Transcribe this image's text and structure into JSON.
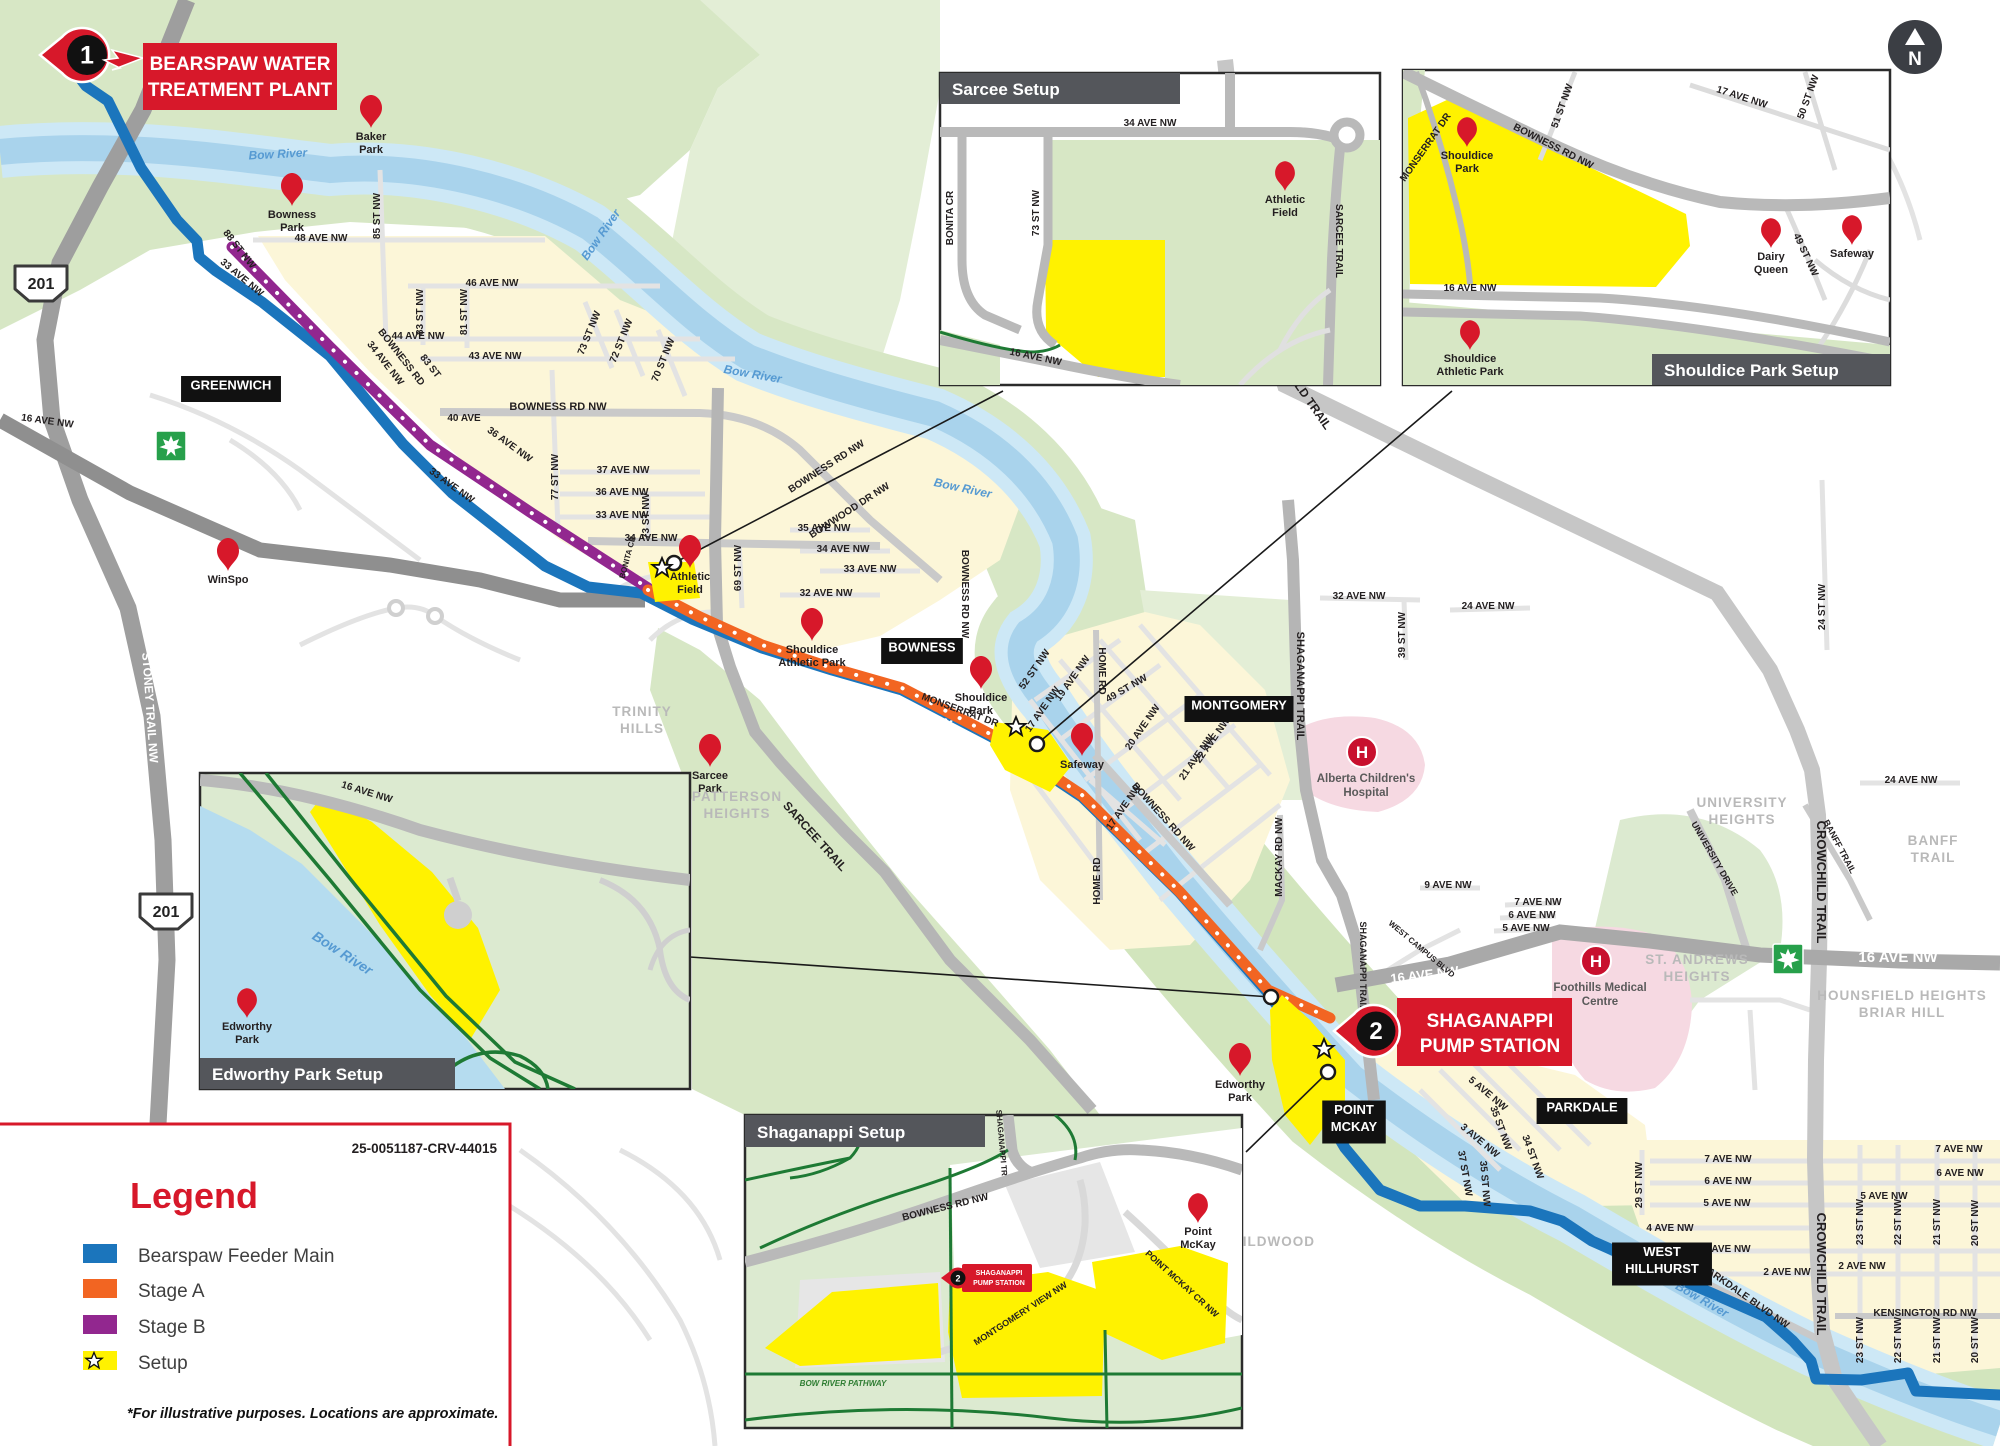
{
  "doc_number": "25-0051187-CRV-44015",
  "north_label": "N",
  "colors": {
    "route_blue": "#1b75bc",
    "stage_a": "#f26522",
    "stage_b": "#92278f",
    "setup_yellow": "#fff200",
    "brand_red": "#d7182a",
    "inset_bar": "#54565b",
    "water": "#a9d3ec",
    "park_green": "#d7e7c5",
    "trail_green": "#1e7a34",
    "hospital_pink": "#f6d9e2"
  },
  "legend": {
    "title": "Legend",
    "items": [
      {
        "label": "Bearspaw Feeder Main",
        "color": "#1b75bc",
        "star": false
      },
      {
        "label": "Stage A",
        "color": "#f26522",
        "star": false
      },
      {
        "label": "Stage B",
        "color": "#92278f",
        "star": false
      },
      {
        "label": "Setup",
        "color": "#fff200",
        "star": true
      }
    ],
    "note": "*For illustrative purposes. Locations are approximate."
  },
  "callouts": {
    "bearspaw": {
      "number": "1",
      "line1": "BEARSPAW WATER",
      "line2": "TREATMENT PLANT"
    },
    "shaganappi": {
      "number": "2",
      "line1": "SHAGANAPPI",
      "line2": "PUMP STATION"
    }
  },
  "insets": {
    "sarcee": {
      "title": "Sarcee Setup"
    },
    "shouldice": {
      "title": "Shouldice Park Setup"
    },
    "edworthy": {
      "title": "Edworthy Park Setup"
    },
    "shaganappi": {
      "title": "Shaganappi Setup"
    }
  },
  "shields": {
    "hwy": "201"
  },
  "map": {
    "street_labels": [
      {
        "t": "16 AVE NW",
        "x": 47,
        "y": 424,
        "r": 8
      },
      {
        "t": "48 AVE NW",
        "x": 321,
        "y": 241
      },
      {
        "t": "85 ST NW",
        "x": 380,
        "y": 216,
        "r": -90
      },
      {
        "t": "88 ST NW",
        "x": 237,
        "y": 251,
        "r": 52
      },
      {
        "t": "33 AVE NW",
        "x": 240,
        "y": 280,
        "r": 40
      },
      {
        "t": "46 AVE NW",
        "x": 492,
        "y": 286
      },
      {
        "t": "83 ST NW",
        "x": 423,
        "y": 312,
        "r": -90
      },
      {
        "t": "81 ST NW",
        "x": 467,
        "y": 312,
        "r": -90
      },
      {
        "t": "44 AVE NW",
        "x": 418,
        "y": 339
      },
      {
        "t": "43 AVE NW",
        "x": 495,
        "y": 359
      },
      {
        "t": "BOWNESS RD",
        "x": 399,
        "y": 359,
        "r": 52
      },
      {
        "t": "34 AVE NW",
        "x": 383,
        "y": 365,
        "r": 52
      },
      {
        "t": "83 ST",
        "x": 428,
        "y": 368,
        "r": 52
      },
      {
        "t": "BOWNESS RD NW",
        "x": 558,
        "y": 410,
        "s": 11
      },
      {
        "t": "40 AVE",
        "x": 464,
        "y": 421
      },
      {
        "t": "36 AVE NW",
        "x": 508,
        "y": 447,
        "r": 36
      },
      {
        "t": "33 AVE NW",
        "x": 450,
        "y": 488,
        "r": 36
      },
      {
        "t": "37 AVE NW",
        "x": 623,
        "y": 473
      },
      {
        "t": "36 AVE NW",
        "x": 622,
        "y": 495
      },
      {
        "t": "33 AVE NW",
        "x": 622,
        "y": 518
      },
      {
        "t": "77 ST NW",
        "x": 558,
        "y": 477,
        "r": -90
      },
      {
        "t": "73 ST NW",
        "x": 592,
        "y": 334,
        "r": -68
      },
      {
        "t": "72 ST NW",
        "x": 624,
        "y": 342,
        "r": -68
      },
      {
        "t": "70 ST NW",
        "x": 666,
        "y": 361,
        "r": -68
      },
      {
        "t": "34 AVE NW",
        "x": 651,
        "y": 541
      },
      {
        "t": "BONITA CR",
        "x": 630,
        "y": 558,
        "r": -75,
        "s": 8
      },
      {
        "t": "73 ST NW",
        "x": 649,
        "y": 516,
        "r": -90
      },
      {
        "t": "69 ST NW",
        "x": 741,
        "y": 568,
        "r": -90
      },
      {
        "t": "40 AVE NW",
        "x": 1055,
        "y": 337
      },
      {
        "t": "35 AVE NW",
        "x": 824,
        "y": 531
      },
      {
        "t": "34 AVE NW",
        "x": 843,
        "y": 552
      },
      {
        "t": "33 AVE NW",
        "x": 870,
        "y": 572
      },
      {
        "t": "32 AVE NW",
        "x": 826,
        "y": 596
      },
      {
        "t": "BOWNESS RD NW",
        "x": 828,
        "y": 469,
        "r": -33
      },
      {
        "t": "BOWWOOD DR NW",
        "x": 851,
        "y": 513,
        "r": -33
      },
      {
        "t": "BOWNESS RD NW",
        "x": 962,
        "y": 594,
        "r": 90
      },
      {
        "t": "MONSERRAT DR",
        "x": 959,
        "y": 713,
        "r": 20
      },
      {
        "t": "16 AVE NW",
        "x": 912,
        "y": 717,
        "r": 20,
        "s": 15,
        "c": "#ffffff"
      },
      {
        "t": "52 ST NW",
        "x": 1037,
        "y": 671,
        "r": -55
      },
      {
        "t": "19 AVE NW",
        "x": 1075,
        "y": 680,
        "r": -55
      },
      {
        "t": "17 AVE NW",
        "x": 1045,
        "y": 711,
        "r": -55
      },
      {
        "t": "HOME RD",
        "x": 1099,
        "y": 671,
        "r": 90
      },
      {
        "t": "49 ST NW",
        "x": 1128,
        "y": 691,
        "r": -30
      },
      {
        "t": "20 AVE NW",
        "x": 1145,
        "y": 729,
        "r": -55
      },
      {
        "t": "22 AVE NW",
        "x": 1215,
        "y": 742,
        "r": -55
      },
      {
        "t": "21 AVE NW",
        "x": 1199,
        "y": 759,
        "r": -55
      },
      {
        "t": "17 AVE NW",
        "x": 1126,
        "y": 809,
        "r": -55
      },
      {
        "t": "BOWNESS RD NW",
        "x": 1161,
        "y": 819,
        "r": 48
      },
      {
        "t": "MACKAY RD NW",
        "x": 1282,
        "y": 857,
        "r": -90
      },
      {
        "t": "HOME RD",
        "x": 1100,
        "y": 881,
        "r": -90
      },
      {
        "t": "SHAGANAPPI TRAIL",
        "x": 1297,
        "y": 686,
        "r": 90,
        "s": 11
      },
      {
        "t": "32 AVE NW",
        "x": 1359,
        "y": 599
      },
      {
        "t": "39 ST NW",
        "x": 1405,
        "y": 635,
        "r": -90
      },
      {
        "t": "24 AVE NW",
        "x": 1488,
        "y": 609
      },
      {
        "t": "24 AVE NW",
        "x": 1911,
        "y": 783
      },
      {
        "t": "24 ST NW",
        "x": 1825,
        "y": 607,
        "r": -90
      },
      {
        "t": "CROWCHILD TRAIL",
        "x": 1293,
        "y": 384,
        "r": 55,
        "s": 12
      },
      {
        "t": "CROWCHILD TRAIL",
        "x": 1817,
        "y": 882,
        "r": 90,
        "s": 13
      },
      {
        "t": "CROWCHILD TRAIL",
        "x": 1817,
        "y": 1274,
        "r": 90,
        "s": 13
      },
      {
        "t": "BANFF TRAIL",
        "x": 1837,
        "y": 848,
        "r": 62,
        "s": 9
      },
      {
        "t": "UNIVERSITY DRIVE",
        "x": 1712,
        "y": 860,
        "r": 60,
        "s": 9
      },
      {
        "t": "16 AVE NW",
        "x": 1898,
        "y": 962,
        "s": 15,
        "c": "#ffffff"
      },
      {
        "t": "16 AVE NW",
        "x": 1425,
        "y": 979,
        "r": -7,
        "s": 13,
        "c": "#ffffff"
      },
      {
        "t": "WEST CAMPUS BLVD",
        "x": 1420,
        "y": 951,
        "r": 40,
        "s": 8
      },
      {
        "t": "SHAGANAPPI TRAIL",
        "x": 1360,
        "y": 966,
        "r": 90,
        "s": 9
      },
      {
        "t": "5 AVE NW",
        "x": 1486,
        "y": 1096,
        "r": 40
      },
      {
        "t": "35 ST NW",
        "x": 1498,
        "y": 1129,
        "r": 70
      },
      {
        "t": "3 AVE NW",
        "x": 1478,
        "y": 1143,
        "r": 40
      },
      {
        "t": "34 ST NW",
        "x": 1530,
        "y": 1158,
        "r": 70
      },
      {
        "t": "37 ST NW",
        "x": 1462,
        "y": 1174,
        "r": 80
      },
      {
        "t": "35 ST NW",
        "x": 1482,
        "y": 1184,
        "r": 85
      },
      {
        "t": "29 ST NW",
        "x": 1642,
        "y": 1185,
        "r": -90
      },
      {
        "t": "7 AVE NW",
        "x": 1728,
        "y": 1162
      },
      {
        "t": "6 AVE NW",
        "x": 1728,
        "y": 1184
      },
      {
        "t": "5 AVE NW",
        "x": 1727,
        "y": 1206
      },
      {
        "t": "4 AVE NW",
        "x": 1670,
        "y": 1231
      },
      {
        "t": "3 AVE NW",
        "x": 1727,
        "y": 1252
      },
      {
        "t": "2 AVE NW",
        "x": 1787,
        "y": 1275
      },
      {
        "t": "2 AVE NW",
        "x": 1862,
        "y": 1269
      },
      {
        "t": "PARKDALE BLVD NW",
        "x": 1744,
        "y": 1299,
        "r": 35
      },
      {
        "t": "KENSINGTON RD NW",
        "x": 1925,
        "y": 1316
      },
      {
        "t": "23 ST NW",
        "x": 1863,
        "y": 1222,
        "r": -90
      },
      {
        "t": "22 ST NW",
        "x": 1901,
        "y": 1222,
        "r": -90
      },
      {
        "t": "21 ST NW",
        "x": 1940,
        "y": 1222,
        "r": -90
      },
      {
        "t": "20 ST NW",
        "x": 1978,
        "y": 1223,
        "r": -90
      },
      {
        "t": "23 ST NW",
        "x": 1863,
        "y": 1340,
        "r": -90
      },
      {
        "t": "22 ST NW",
        "x": 1901,
        "y": 1340,
        "r": -90
      },
      {
        "t": "21 ST NW",
        "x": 1940,
        "y": 1340,
        "r": -90
      },
      {
        "t": "20 ST NW",
        "x": 1978,
        "y": 1340,
        "r": -90
      },
      {
        "t": "7 AVE NW",
        "x": 1959,
        "y": 1152
      },
      {
        "t": "6 AVE NW",
        "x": 1960,
        "y": 1176
      },
      {
        "t": "5 AVE NW",
        "x": 1884,
        "y": 1199
      },
      {
        "t": "9 AVE NW",
        "x": 1448,
        "y": 888
      },
      {
        "t": "7 AVE NW",
        "x": 1538,
        "y": 905
      },
      {
        "t": "6 AVE NW",
        "x": 1532,
        "y": 918
      },
      {
        "t": "5 AVE NW",
        "x": 1526,
        "y": 931
      },
      {
        "t": "STONEY TRAIL NW",
        "x": 146,
        "y": 708,
        "r": 86,
        "s": 12,
        "c": "#ffffff"
      },
      {
        "t": "SARCEE TRAIL",
        "x": 812,
        "y": 839,
        "r": 48,
        "s": 12
      }
    ],
    "river_labels": [
      {
        "t": "Bow River",
        "x": 278,
        "y": 158,
        "r": -3
      },
      {
        "t": "Bow River",
        "x": 604,
        "y": 237,
        "r": -55
      },
      {
        "t": "Bow River",
        "x": 752,
        "y": 378,
        "r": 10
      },
      {
        "t": "Bow River",
        "x": 962,
        "y": 492,
        "r": 12
      },
      {
        "t": "Bow River",
        "x": 1700,
        "y": 1303,
        "r": 30
      }
    ],
    "pins": [
      {
        "lines": [
          "Baker",
          "Park"
        ],
        "x": 371,
        "y": 128
      },
      {
        "lines": [
          "Bowness",
          "Park"
        ],
        "x": 292,
        "y": 206
      },
      {
        "lines": [
          "WinSpo"
        ],
        "x": 228,
        "y": 571
      },
      {
        "lines": [
          "Sarcee",
          "Park"
        ],
        "x": 710,
        "y": 767
      },
      {
        "lines": [
          "Shouldice",
          "Park"
        ],
        "x": 981,
        "y": 689
      },
      {
        "lines": [
          "Safeway"
        ],
        "x": 1082,
        "y": 756
      },
      {
        "lines": [
          "Shouldice",
          "Athletic Park"
        ],
        "x": 812,
        "y": 641
      },
      {
        "lines": [
          "Edworthy",
          "Park"
        ],
        "x": 1240,
        "y": 1076
      },
      {
        "lines": [
          "Athletic",
          "Field"
        ],
        "x": 690,
        "y": 568
      }
    ],
    "black_boxes": [
      {
        "lines": [
          "GREENWICH"
        ],
        "x": 231,
        "y": 389
      },
      {
        "lines": [
          "BOWNESS"
        ],
        "x": 922,
        "y": 651
      },
      {
        "lines": [
          "MONTGOMERY"
        ],
        "x": 1239,
        "y": 709
      },
      {
        "lines": [
          "POINT",
          "MCKAY"
        ],
        "x": 1354,
        "y": 1122
      },
      {
        "lines": [
          "PARKDALE"
        ],
        "x": 1582,
        "y": 1111
      },
      {
        "lines": [
          "WEST",
          "HILLHURST"
        ],
        "x": 1662,
        "y": 1264
      }
    ],
    "gray_labels": [
      {
        "lines": [
          "TRINITY",
          "HILLS"
        ],
        "x": 642,
        "y": 716
      },
      {
        "lines": [
          "PATTERSON",
          "HEIGHTS"
        ],
        "x": 737,
        "y": 801
      },
      {
        "lines": [
          "WILDWOOD"
        ],
        "x": 1272,
        "y": 1246
      },
      {
        "lines": [
          "UNIVERSITY",
          "HEIGHTS"
        ],
        "x": 1742,
        "y": 807
      },
      {
        "lines": [
          "BANFF",
          "TRAIL"
        ],
        "x": 1933,
        "y": 845
      },
      {
        "lines": [
          "ST. ANDREWS",
          "HEIGHTS"
        ],
        "x": 1697,
        "y": 964
      },
      {
        "lines": [
          "HOUNSFIELD HEIGHTS",
          "BRIAR HILL"
        ],
        "x": 1902,
        "y": 1000
      }
    ],
    "hospitals": [
      {
        "symbol": "H",
        "lines": [
          "Alberta Children's",
          "Hospital"
        ],
        "x": 1362,
        "y": 752
      },
      {
        "symbol": "H",
        "lines": [
          "Foothills Medical",
          "Centre"
        ],
        "x": 1596,
        "y": 961
      }
    ],
    "shields_201": [
      {
        "x": 41,
        "y": 283
      },
      {
        "x": 166,
        "y": 911
      }
    ],
    "shields_tch": [
      {
        "x": 171,
        "y": 446,
        "s": 1
      },
      {
        "x": 1788,
        "y": 959,
        "s": 1
      },
      {
        "x": 997,
        "y": 352,
        "s": 0.8
      },
      {
        "x": 1429,
        "y": 297,
        "s": 0.8
      },
      {
        "x": 410,
        "y": 821,
        "s": 0.8
      }
    ],
    "setup_stars": [
      {
        "x": 662,
        "y": 568
      },
      {
        "x": 1016,
        "y": 727
      },
      {
        "x": 1324,
        "y": 1049
      }
    ]
  },
  "inset_content": {
    "sarcee": {
      "street_labels": [
        {
          "t": "34 AVE NW",
          "x": 1150,
          "y": 126
        },
        {
          "t": "BONITA CR",
          "x": 953,
          "y": 218,
          "r": -90
        },
        {
          "t": "73 ST NW",
          "x": 1039,
          "y": 213,
          "r": -90
        },
        {
          "t": "SARCEE TRAIL",
          "x": 1336,
          "y": 241,
          "r": 90
        },
        {
          "t": "16 AVE NW",
          "x": 1035,
          "y": 360,
          "r": 12
        }
      ],
      "pins": [
        {
          "lines": [
            "Athletic",
            "Field"
          ],
          "x": 1285,
          "y": 191,
          "s": 0.9
        }
      ]
    },
    "shouldice": {
      "street_labels": [
        {
          "t": "MONSERRAT DR",
          "x": 1428,
          "y": 149,
          "r": -55
        },
        {
          "t": "BOWNESS RD NW",
          "x": 1552,
          "y": 149,
          "r": 27
        },
        {
          "t": "51 ST NW",
          "x": 1565,
          "y": 107,
          "r": -70
        },
        {
          "t": "17 AVE NW",
          "x": 1741,
          "y": 100,
          "r": 18
        },
        {
          "t": "50 ST NW",
          "x": 1811,
          "y": 98,
          "r": -70
        },
        {
          "t": "49 ST NW",
          "x": 1803,
          "y": 256,
          "r": 65
        },
        {
          "t": "16 AVE NW",
          "x": 1470,
          "y": 291
        }
      ],
      "pins": [
        {
          "lines": [
            "Shouldice",
            "Park"
          ],
          "x": 1467,
          "y": 147,
          "s": 0.9
        },
        {
          "lines": [
            "Dairy",
            "Queen"
          ],
          "x": 1771,
          "y": 248,
          "s": 0.9
        },
        {
          "lines": [
            "Safeway"
          ],
          "x": 1852,
          "y": 245,
          "s": 0.9
        },
        {
          "lines": [
            "Shouldice",
            "Athletic Park"
          ],
          "x": 1470,
          "y": 350,
          "s": 0.9
        }
      ]
    },
    "edworthy": {
      "street_labels": [
        {
          "t": "16 AVE NW",
          "x": 366,
          "y": 795,
          "r": 17
        }
      ],
      "river_labels": [
        {
          "t": "Bow River",
          "x": 340,
          "y": 957,
          "r": 33,
          "s": 14
        }
      ],
      "pins": [
        {
          "lines": [
            "Edworthy",
            "Park"
          ],
          "x": 247,
          "y": 1018,
          "s": 0.9
        }
      ]
    },
    "shaganappi": {
      "street_labels": [
        {
          "t": "SHAGANAPPI TR",
          "x": 999,
          "y": 1143,
          "r": 85,
          "s": 8
        },
        {
          "t": "BOWNESS RD NW",
          "x": 946,
          "y": 1210,
          "r": -14
        },
        {
          "t": "MONTGOMERY VIEW NW",
          "x": 1022,
          "y": 1316,
          "r": -33,
          "s": 9
        },
        {
          "t": "POINT MCKAY CR NW",
          "x": 1180,
          "y": 1286,
          "r": 42,
          "s": 9
        },
        {
          "t": "BOW RIVER PATHWAY",
          "x": 843,
          "y": 1386,
          "s": 8,
          "c": "#2e7d32",
          "i": 1
        }
      ],
      "pins": [
        {
          "lines": [
            "Point",
            "McKay"
          ],
          "x": 1198,
          "y": 1223,
          "s": 0.9
        }
      ],
      "pump_badge": {
        "number": "2",
        "line1": "SHAGANAPPI",
        "line2": "PUMP STATION"
      }
    }
  }
}
